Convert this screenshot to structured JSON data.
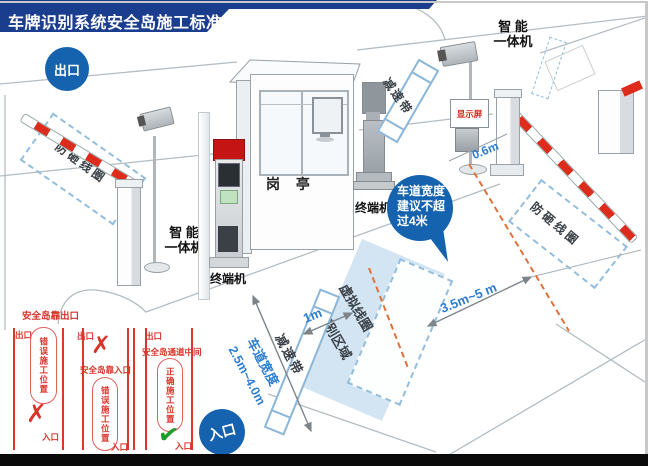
{
  "title": "车牌识别系统安全岛施工标准",
  "badges": {
    "exit": "出口",
    "entry": "入口"
  },
  "bubble": {
    "line1": "车道宽度",
    "line2": "建议不超",
    "line3": "过4米"
  },
  "equipment": {
    "camera_left_line1": "智 能",
    "camera_left_line2": "一体机",
    "camera_right_line1": "智 能",
    "camera_right_line2": "一体机",
    "booth": "岗 亭",
    "terminal_left": "终端机",
    "terminal_right": "终端机",
    "display_screen": "显示屏"
  },
  "zones": {
    "anti_smash_loop_left": "防砸线圈",
    "anti_smash_loop_right": "防砸线圈",
    "speed_bump_top": "减速带",
    "speed_bump_bottom": "减速带",
    "virtual_loop": "虚拟线圈",
    "recognition_area": "识别区域"
  },
  "measurements": {
    "camera_offset": "0.6m",
    "bump_to_loop": "1m",
    "loop_to_gate": "3.5m~5 m",
    "lane_width_title": "车道宽度",
    "lane_width_range": "2.5m~4.0m"
  },
  "comparison": {
    "header": "安全岛靠出口",
    "panels": [
      {
        "exit": "出口",
        "entry": "入口",
        "note": "",
        "position_label": "错误施工位置",
        "mark": "✗"
      },
      {
        "exit": "出口",
        "entry": "入口",
        "note": "安全岛靠入口",
        "position_label": "错误施工位置",
        "mark": "✗"
      },
      {
        "exit": "出口",
        "entry": "入口",
        "note": "安全岛通道中间",
        "position_label": "正确施工位置",
        "mark": "✔"
      }
    ]
  },
  "colors": {
    "banner_navy": "#1b3d8e",
    "badge_blue": "#1563ae",
    "measure_blue": "#2e7ed0",
    "loop_dash_blue": "#93bedd",
    "area_fill_blue": "#d3e5f3",
    "alert_red": "#d8342a",
    "stripe_red": "#dd2b1c",
    "check_green": "#1f9c28",
    "orange_dash": "#e2703a"
  }
}
